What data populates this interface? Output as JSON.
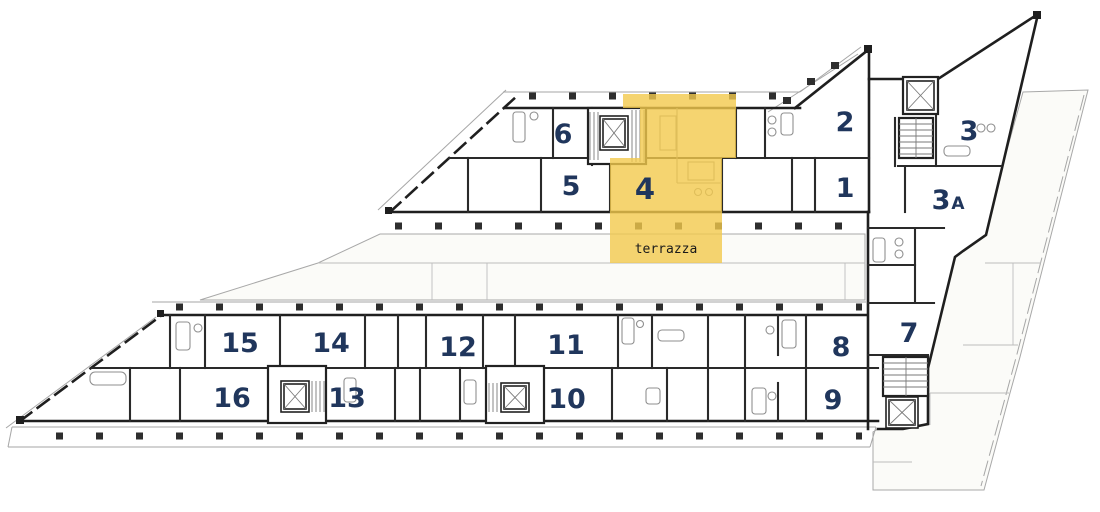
{
  "plan": {
    "highlight_color": "#f2c94c",
    "highlight_opacity": "0.8",
    "label_color": "#20365c",
    "terrace_label": "terrazza",
    "highlighted_unit": "4",
    "units": [
      {
        "id": "1",
        "label": "1"
      },
      {
        "id": "2",
        "label": "2"
      },
      {
        "id": "3",
        "label": "3"
      },
      {
        "id": "3A",
        "label": "3",
        "suffix": "A"
      },
      {
        "id": "4",
        "label": "4",
        "highlighted": true
      },
      {
        "id": "5",
        "label": "5"
      },
      {
        "id": "6",
        "label": "6"
      },
      {
        "id": "7",
        "label": "7"
      },
      {
        "id": "8",
        "label": "8"
      },
      {
        "id": "9",
        "label": "9"
      },
      {
        "id": "10",
        "label": "10"
      },
      {
        "id": "11",
        "label": "11"
      },
      {
        "id": "12",
        "label": "12"
      },
      {
        "id": "13",
        "label": "13"
      },
      {
        "id": "14",
        "label": "14"
      },
      {
        "id": "15",
        "label": "15"
      },
      {
        "id": "16",
        "label": "16"
      }
    ]
  }
}
